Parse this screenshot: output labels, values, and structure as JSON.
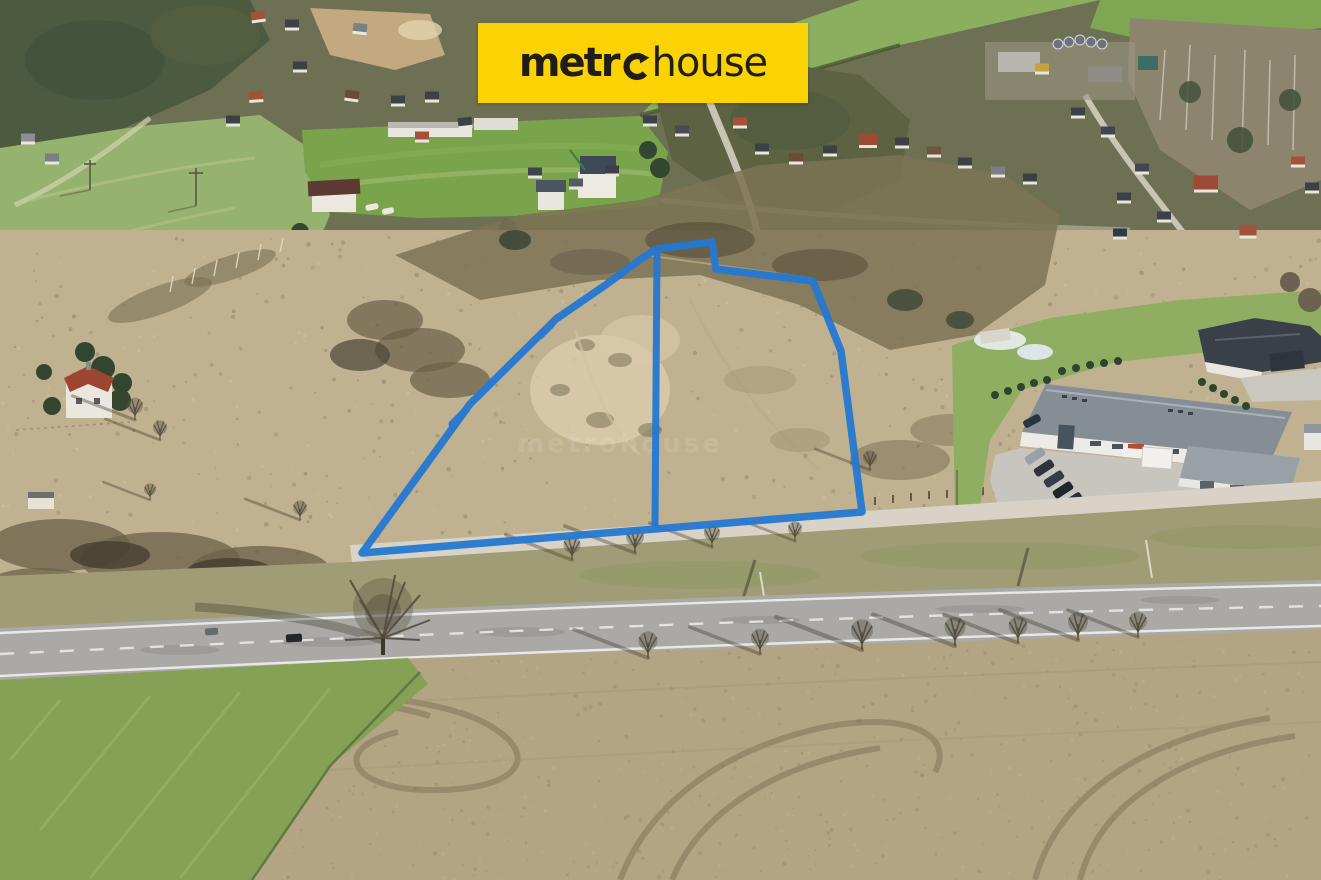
{
  "brand": {
    "wordmark_full": "metrohouse",
    "wordmark_prefix": "metr",
    "wordmark_suffix": "house",
    "banner_color": "#FBD204",
    "text_color": "#201E16"
  },
  "watermark": {
    "text": "metrohouse"
  },
  "parcel_overlay": {
    "color": "#2478D2",
    "outline_points": "362,553 470,404 556,319 607,284 641,259 656,249 712,242 716,269 813,281 841,351 862,512",
    "divider_points": "657,250 655,527"
  }
}
